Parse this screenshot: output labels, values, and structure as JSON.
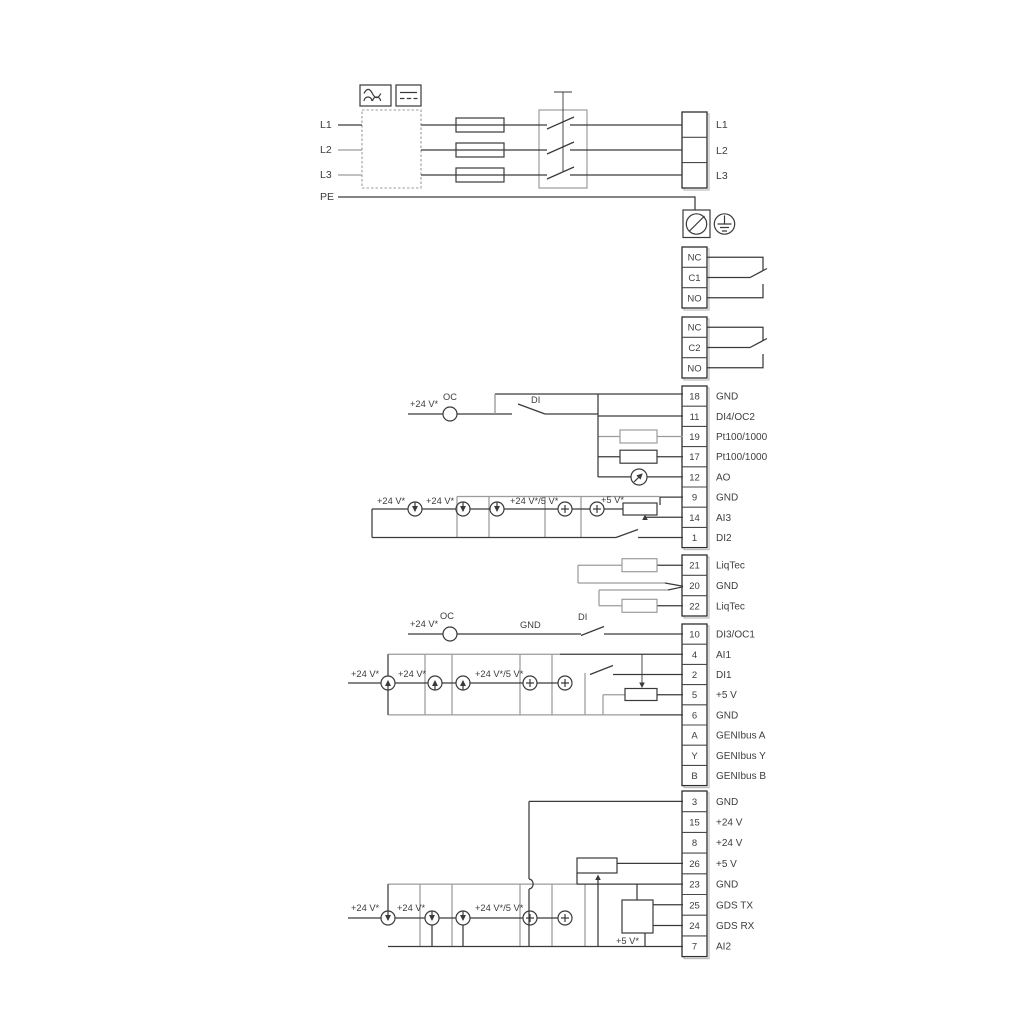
{
  "diagram_title": "Drive wiring and terminal connection diagram",
  "colors": {
    "line_dark": "#3a3a3a",
    "line_gray": "#9c9c9c",
    "text": "#3d3d3d",
    "background": "#ffffff"
  },
  "power_in": [
    "L1",
    "L2",
    "L3",
    "PE"
  ],
  "power_out": [
    "L1",
    "L2",
    "L3"
  ],
  "relay1": [
    "NC",
    "C1",
    "NO"
  ],
  "relay2": [
    "NC",
    "C2",
    "NO"
  ],
  "io1": [
    {
      "n": "18",
      "t": "GND"
    },
    {
      "n": "11",
      "t": "DI4/OC2"
    },
    {
      "n": "19",
      "t": "Pt100/1000"
    },
    {
      "n": "17",
      "t": "Pt100/1000"
    },
    {
      "n": "12",
      "t": "AO"
    },
    {
      "n": "9",
      "t": "GND"
    },
    {
      "n": "14",
      "t": "AI3"
    },
    {
      "n": "1",
      "t": "DI2"
    }
  ],
  "liqtec": [
    {
      "n": "21",
      "t": "LiqTec"
    },
    {
      "n": "20",
      "t": "GND"
    },
    {
      "n": "22",
      "t": "LiqTec"
    }
  ],
  "io2": [
    {
      "n": "10",
      "t": "DI3/OC1"
    },
    {
      "n": "4",
      "t": "AI1"
    },
    {
      "n": "2",
      "t": "DI1"
    },
    {
      "n": "5",
      "t": "+5 V"
    },
    {
      "n": "6",
      "t": "GND"
    },
    {
      "n": "A",
      "t": "GENIbus A"
    },
    {
      "n": "Y",
      "t": "GENIbus Y"
    },
    {
      "n": "B",
      "t": "GENIbus B"
    }
  ],
  "io3": [
    {
      "n": "3",
      "t": "GND"
    },
    {
      "n": "15",
      "t": "+24 V"
    },
    {
      "n": "8",
      "t": "+24 V"
    },
    {
      "n": "26",
      "t": "+5 V"
    },
    {
      "n": "23",
      "t": "GND"
    },
    {
      "n": "25",
      "t": "GDS TX"
    },
    {
      "n": "24",
      "t": "GDS RX"
    },
    {
      "n": "7",
      "t": "AI2"
    }
  ],
  "ann": [
    "+24 V*",
    "OC",
    "DI",
    "+24 V*",
    "+24 V*",
    "+24 V*/5 V*",
    "+5 V*",
    "+24 V*",
    "OC",
    "GND",
    "DI",
    "+24 V*",
    "+24 V*",
    "+24 V*/5 V*",
    "+24 V*",
    "+24 V*",
    "+24 V*/5 V*",
    "+5 V*"
  ],
  "icons": {
    "converter_ac": "ac-waveform-icon",
    "converter_dc": "dc-lines-icon",
    "fuse": "fuse-icon",
    "main_switch": "main-switch-icon",
    "cable_gland": "cable-gland-icon",
    "earth": "protective-earth-icon",
    "open_collector": "open-collector-circle-icon",
    "current_source": "current-source-arrow-icon",
    "voltage_source": "plus-source-icon",
    "meter": "analog-output-meter-icon",
    "potentiometer": "potentiometer-icon",
    "sensor_resistor": "resistor-icon",
    "gds_sensor": "gds-sensor-box-icon"
  }
}
